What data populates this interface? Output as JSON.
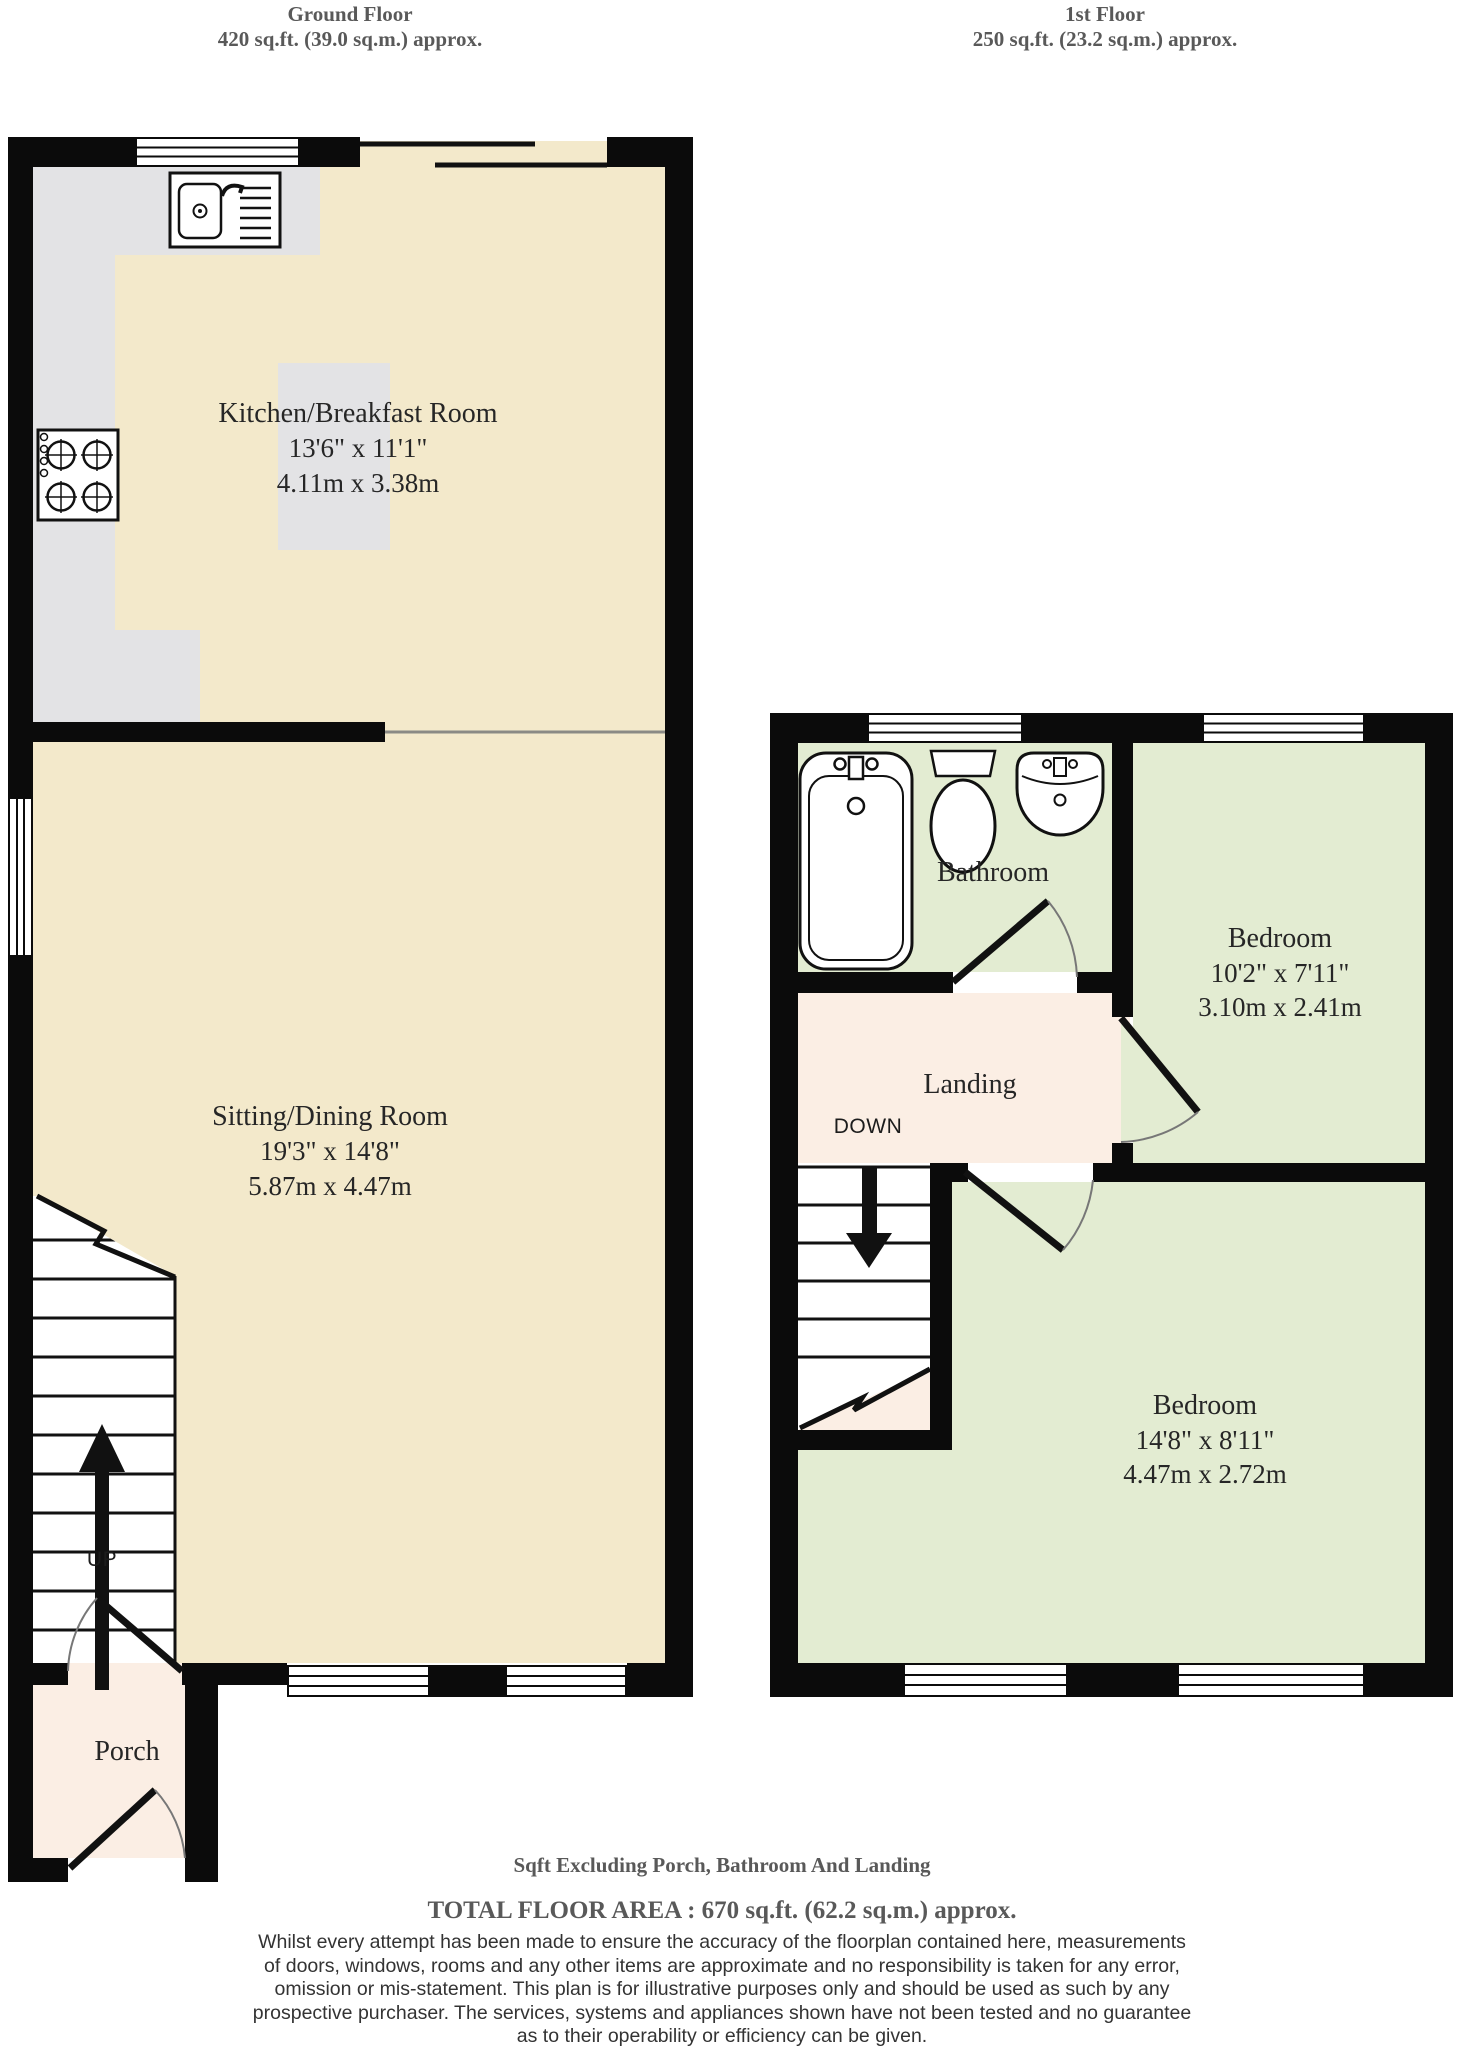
{
  "headers": {
    "ground": {
      "title": "Ground Floor",
      "area": "420 sq.ft. (39.0 sq.m.) approx."
    },
    "first": {
      "title": "1st Floor",
      "area": "250 sq.ft. (23.2 sq.m.) approx."
    }
  },
  "ground_floor": {
    "kitchen": {
      "name": "Kitchen/Breakfast Room",
      "dims_imperial": "13'6\"  x 11'1\"",
      "dims_metric": "4.11m  x 3.38m"
    },
    "sitting": {
      "name": "Sitting/Dining Room",
      "dims_imperial": "19'3\"  x 14'8\"",
      "dims_metric": "5.87m  x 4.47m"
    },
    "porch": {
      "name": "Porch"
    },
    "stairs_label": "UP"
  },
  "first_floor": {
    "bathroom": {
      "name": "Bathroom"
    },
    "landing": {
      "name": "Landing"
    },
    "bedroom1": {
      "name": "Bedroom",
      "dims_imperial": "10'2\"  x 7'11\"",
      "dims_metric": "3.10m  x 2.41m"
    },
    "bedroom2": {
      "name": "Bedroom",
      "dims_imperial": "14'8\"  x 8'11\"",
      "dims_metric": "4.47m  x 2.72m"
    },
    "stairs_label": "DOWN"
  },
  "footer": {
    "exclusion_note": "Sqft Excluding Porch, Bathroom And Landing",
    "total_area": "TOTAL FLOOR AREA : 670 sq.ft. (62.2 sq.m.) approx.",
    "disclaimer_lines": [
      "Whilst every attempt has been made to ensure the accuracy of the floorplan contained here, measurements",
      "of doors, windows, rooms and any other items are approximate and no responsibility is taken for any error,",
      "omission or mis-statement. This plan is for illustrative purposes only and should be used as such by any",
      "prospective purchaser. The services, systems and appliances shown have not been tested and no guarantee",
      "as to their operability or efficiency can be given.",
      "Made with Metropix ©2025"
    ]
  },
  "colors": {
    "wall": "#0b0b0b",
    "floor_cream": "#f3e9cb",
    "floor_green": "#e3ecd2",
    "floor_pink": "#fbeee4",
    "counter_gray": "#e3e3e5",
    "label_dark": "#262626",
    "heading_gray": "#595959",
    "disclaimer_dark": "#333333"
  }
}
